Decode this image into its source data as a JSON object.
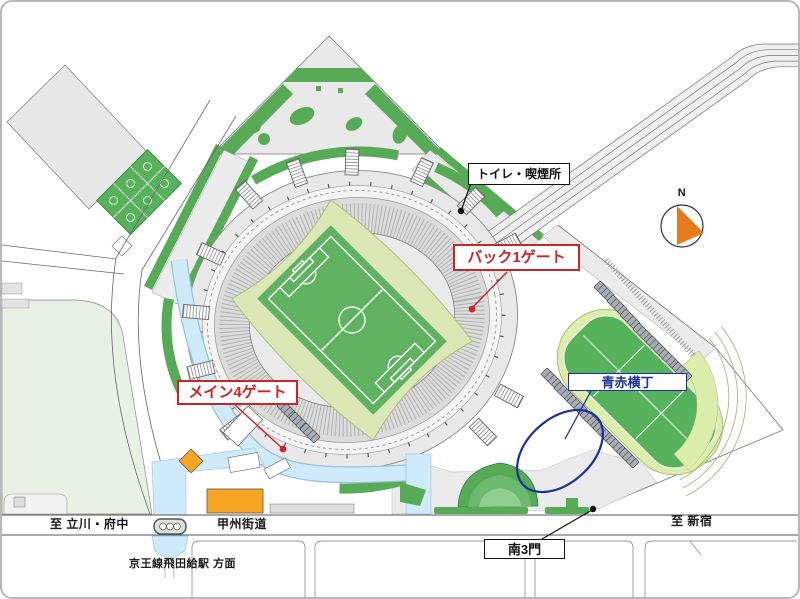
{
  "legend_labels": {
    "toilet_smoking": "トイレ・喫煙所",
    "back1_gate": "バック1ゲート",
    "main4_gate": "メイン4ゲート",
    "aoaka_yokocho": "青赤横丁",
    "south3_gate": "南3門"
  },
  "road_labels": {
    "to_tachikawa_fuchu": "至 立川・府中",
    "koshu_kaido": "甲州街道",
    "to_shinjuku": "至 新宿",
    "keio_line_station": "京王線飛田給駅 方面"
  },
  "compass": {
    "north": "N"
  },
  "colors": {
    "gate_red": "#c9252a",
    "yokocho_blue": "#1b2f9e",
    "landscape_green": "#57ab57",
    "pitch_green": "#5fb360",
    "infield_pale_green": "#dbe7b5",
    "aux_field_ring": "#dcedac",
    "pedestrian_deck_blue": "#cfeafa",
    "building_orange": "#f6a623",
    "compass_orange": "#e87a1e",
    "concourse_gray": "#e8e8e8"
  }
}
